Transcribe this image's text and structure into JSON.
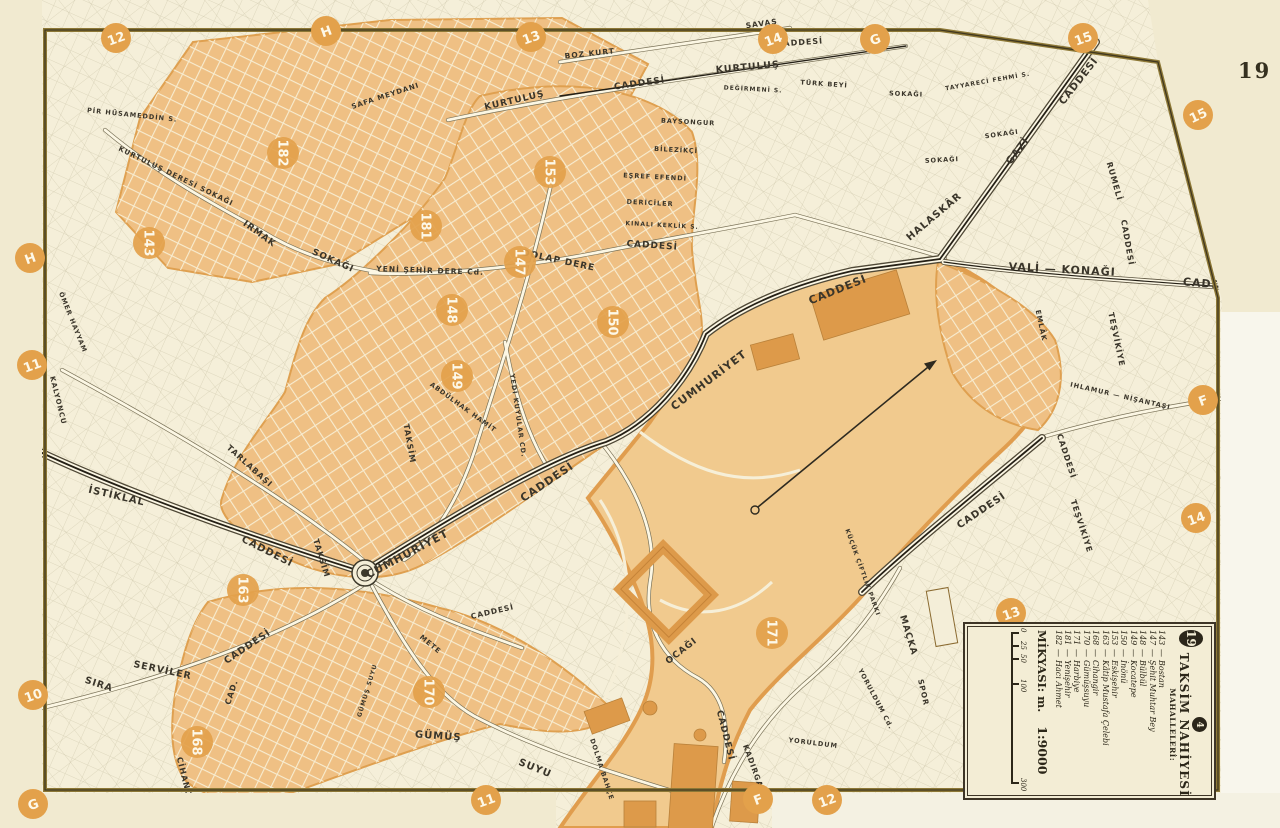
{
  "page": {
    "number": "19"
  },
  "colors": {
    "paper": "#efe8cc",
    "map_bg": "#f5efd9",
    "street": "#fcf7e4",
    "block_orange": "#efc084",
    "field_orange": "#f1ca8e",
    "building_orange": "#dd9a4a",
    "circle_orange": "#e3a14b",
    "ink": "#3a352a",
    "border_gold": "#8d7836"
  },
  "legend": {
    "district_badge": "19",
    "section_badge": "4",
    "title": "TAKSİM NAHİYESİ",
    "subtitle": "MAHALLELERİ:",
    "items": [
      {
        "num": "143",
        "name": "Bostan"
      },
      {
        "num": "147",
        "name": "Şehit Muhtar Bey"
      },
      {
        "num": "148",
        "name": "Bülbül"
      },
      {
        "num": "149",
        "name": "Kocatepe"
      },
      {
        "num": "150",
        "name": "İnönü"
      },
      {
        "num": "153",
        "name": "Eskişehir"
      },
      {
        "num": "163",
        "name": "Kâtip Mustafa Çelebi"
      },
      {
        "num": "168",
        "name": "Cihangir"
      },
      {
        "num": "170",
        "name": "Gümüşsuyu"
      },
      {
        "num": "171",
        "name": "Harbiye"
      },
      {
        "num": "181",
        "name": "Yenişehir"
      },
      {
        "num": "182",
        "name": "Hacı Ahmet"
      }
    ],
    "scale_label": "MİKYASI: m.",
    "scale_value": "1:9000",
    "scale_ticks": [
      "0",
      "25",
      "50",
      "100",
      "300"
    ]
  },
  "grid_refs": [
    {
      "label": "12"
    },
    {
      "label": "H"
    },
    {
      "label": "13"
    },
    {
      "label": "14"
    },
    {
      "label": "G"
    },
    {
      "label": "15"
    },
    {
      "label": "15"
    },
    {
      "label": "F"
    },
    {
      "label": "14"
    },
    {
      "label": "13"
    },
    {
      "label": "H"
    },
    {
      "label": "11"
    },
    {
      "label": "10"
    },
    {
      "label": "G"
    },
    {
      "label": "11"
    },
    {
      "label": "F"
    },
    {
      "label": "12"
    }
  ],
  "mahalle_circles": [
    {
      "number": "182"
    },
    {
      "number": "143"
    },
    {
      "number": "181"
    },
    {
      "number": "153"
    },
    {
      "number": "147"
    },
    {
      "number": "148"
    },
    {
      "number": "150"
    },
    {
      "number": "149"
    },
    {
      "number": "163"
    },
    {
      "number": "168"
    },
    {
      "number": "170"
    },
    {
      "number": "171"
    }
  ],
  "streets": [
    {
      "label": "KURTULUŞ"
    },
    {
      "label": "CADDESİ"
    },
    {
      "label": "KURTULUŞ"
    },
    {
      "label": "CADDESİ"
    },
    {
      "label": "BOZ KURT"
    },
    {
      "label": "SAVAŞ"
    },
    {
      "label": "KURTULUŞ DERESİ SOKAĞI"
    },
    {
      "label": "IRMAK"
    },
    {
      "label": "SOKAĞI"
    },
    {
      "label": "PİR HÜSAMEDDİN S."
    },
    {
      "label": "SAFA MEYDANI"
    },
    {
      "label": "YENİ ŞEHİR DERE Cd."
    },
    {
      "label": "DOLAP DERE"
    },
    {
      "label": "CADDESİ"
    },
    {
      "label": "BAYSONGUR"
    },
    {
      "label": "BİLEZİKÇİ"
    },
    {
      "label": "EŞREF EFENDİ"
    },
    {
      "label": "DERİCİLER"
    },
    {
      "label": "KINALI KEKLİK S."
    },
    {
      "label": "TÜRK BEYİ"
    },
    {
      "label": "TAYYARECİ FEHMİ S."
    },
    {
      "label": "GAZİ"
    },
    {
      "label": "CADDESİ"
    },
    {
      "label": "HALASKÂR"
    },
    {
      "label": "VALİ — KONAĞI"
    },
    {
      "label": "CADD"
    },
    {
      "label": "RUMELİ"
    },
    {
      "label": "CADDESİ"
    },
    {
      "label": "TEŞVİKİYE"
    },
    {
      "label": "IHLAMUR — NİŞANTAŞI"
    },
    {
      "label": "TEŞVİKİYE"
    },
    {
      "label": "EMLÂK"
    },
    {
      "label": "CADDESİ"
    },
    {
      "label": "CUMHURİYET"
    },
    {
      "label": "CADDESİ"
    },
    {
      "label": "CUMHURİYET"
    },
    {
      "label": "CADDESİ"
    },
    {
      "label": "İSTİKLAL"
    },
    {
      "label": "CADDESİ"
    },
    {
      "label": "TAKSİM"
    },
    {
      "label": "TAKSİM"
    },
    {
      "label": "TARLABAŞI"
    },
    {
      "label": "KALYONCU"
    },
    {
      "label": "ÖMER HAYYAM"
    },
    {
      "label": "YEDİ KUYULAR CD."
    },
    {
      "label": "ABDÜLHAK HAMİT"
    },
    {
      "label": "SIRA"
    },
    {
      "label": "SERVİLER"
    },
    {
      "label": "CADDESİ"
    },
    {
      "label": "CAD."
    },
    {
      "label": "CİHANGİR"
    },
    {
      "label": "GÜMÜŞ"
    },
    {
      "label": "SUYU"
    },
    {
      "label": "GÜMÜŞ SUYU"
    },
    {
      "label": "METE"
    },
    {
      "label": "CADDESİ"
    },
    {
      "label": "OCAĞI"
    },
    {
      "label": "CADDESİ"
    },
    {
      "label": "KADIRGALAR"
    },
    {
      "label": "YORULDUM"
    },
    {
      "label": "YORULDUM Cd."
    },
    {
      "label": "MAÇKA"
    },
    {
      "label": "SPOR"
    },
    {
      "label": "KÜÇÜK ÇİFTLİK PARKI"
    },
    {
      "label": "CADDESİ"
    },
    {
      "label": "DOLMA BAHÇE"
    },
    {
      "label": "DEĞİRMENİ S."
    },
    {
      "label": "SOKAĞI"
    },
    {
      "label": "SOKAĞI"
    },
    {
      "label": "SOKAĞI"
    }
  ]
}
